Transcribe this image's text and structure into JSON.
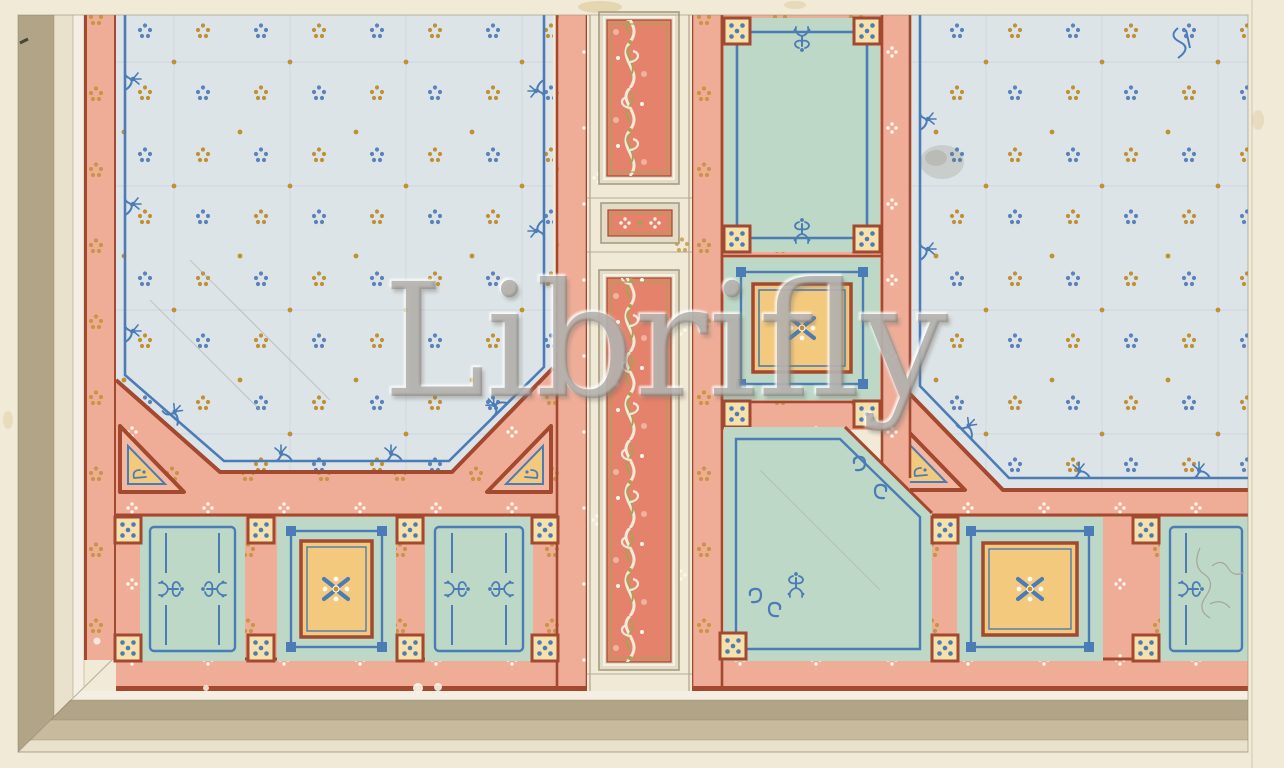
{
  "watermark": {
    "text": "Librifly"
  },
  "artwork": {
    "motifs": [
      "dot-cluster-blue",
      "dot-cluster-gold",
      "rinceau-scroll",
      "x-star-rosette",
      "dice-dot-square",
      "corner-triangle",
      "fleur-knot",
      "pencil-sketch"
    ]
  },
  "palette": {
    "paper": "#f1ead6",
    "tan_band": "#b2a486",
    "light_tan_band": "#c8bb9d",
    "cream_band": "#e9e1cb",
    "white_band": "#f4efe2",
    "salmon_band": "#efad98",
    "coral_panel": "#e5826c",
    "red_line": "#a3492f",
    "pale_blue_field": "#dde4e7",
    "ornament_blue": "#4b7cb6",
    "dot_blue": "#5b83bb",
    "dot_gold": "#c09035",
    "celadon_panel": "#bdd8c6",
    "gold_panel": "#f3c97e",
    "dice_square": "#f6e0ac",
    "frame_gray": "#a89c82",
    "watermark_gray": "#7d7a74"
  }
}
